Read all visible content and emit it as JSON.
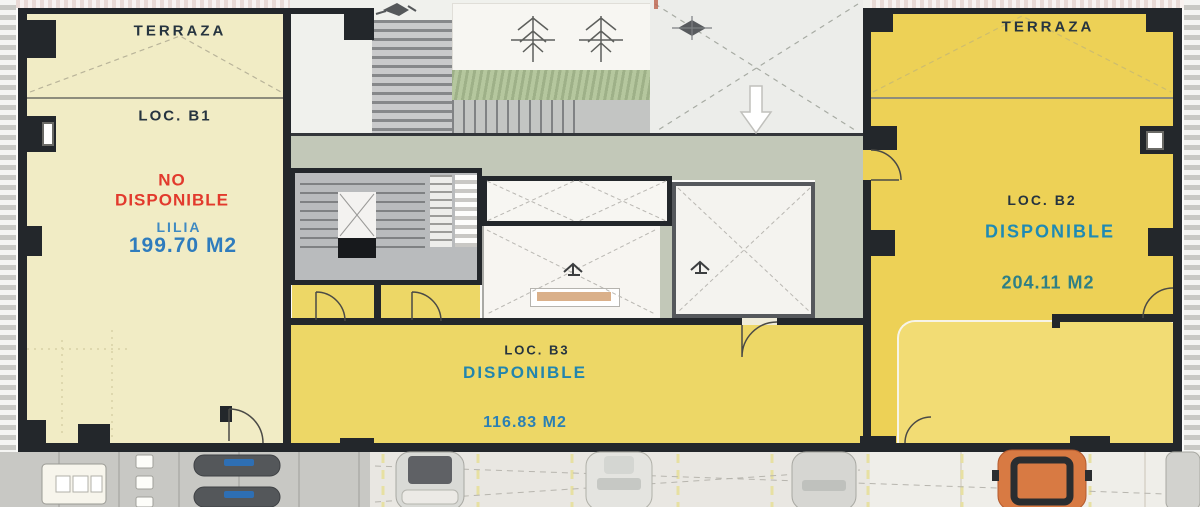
{
  "units": {
    "b1": {
      "terrace_label": "TERRAZA",
      "name": "LOC. B1",
      "status": "NO DISPONIBLE",
      "tenant": "LILIA",
      "area": "199.70 M2"
    },
    "b2": {
      "terrace_label": "TERRAZA",
      "name": "LOC. B2",
      "status": "DISPONIBLE",
      "area": "204.11 M2"
    },
    "b3": {
      "name": "LOC. B3",
      "status": "DISPONIBLE",
      "area": "116.83 M2"
    }
  },
  "colors": {
    "status_not_available_red": "#e23a2d",
    "status_available_blue": "#1f8ab4",
    "tenant_blue": "#3f8ac2",
    "area_blue": "#2f7cbd",
    "area_teal": "#2e7f86",
    "label_dark": "#26343f",
    "unit_b1_fill": "#f1ecc5",
    "unit_b2_fill": "#edd156",
    "unit_b3_fill": "#edd766",
    "wall": "#23272b",
    "path_sage": "#c2c8b8",
    "hedge_green": "#b5c79e"
  },
  "icons": {
    "down-arrow-icon": "↓",
    "pine-tree-icon": "✳",
    "drain-icon": "◆",
    "door-swing-arc": "◜",
    "car-top-icon": "▭"
  }
}
